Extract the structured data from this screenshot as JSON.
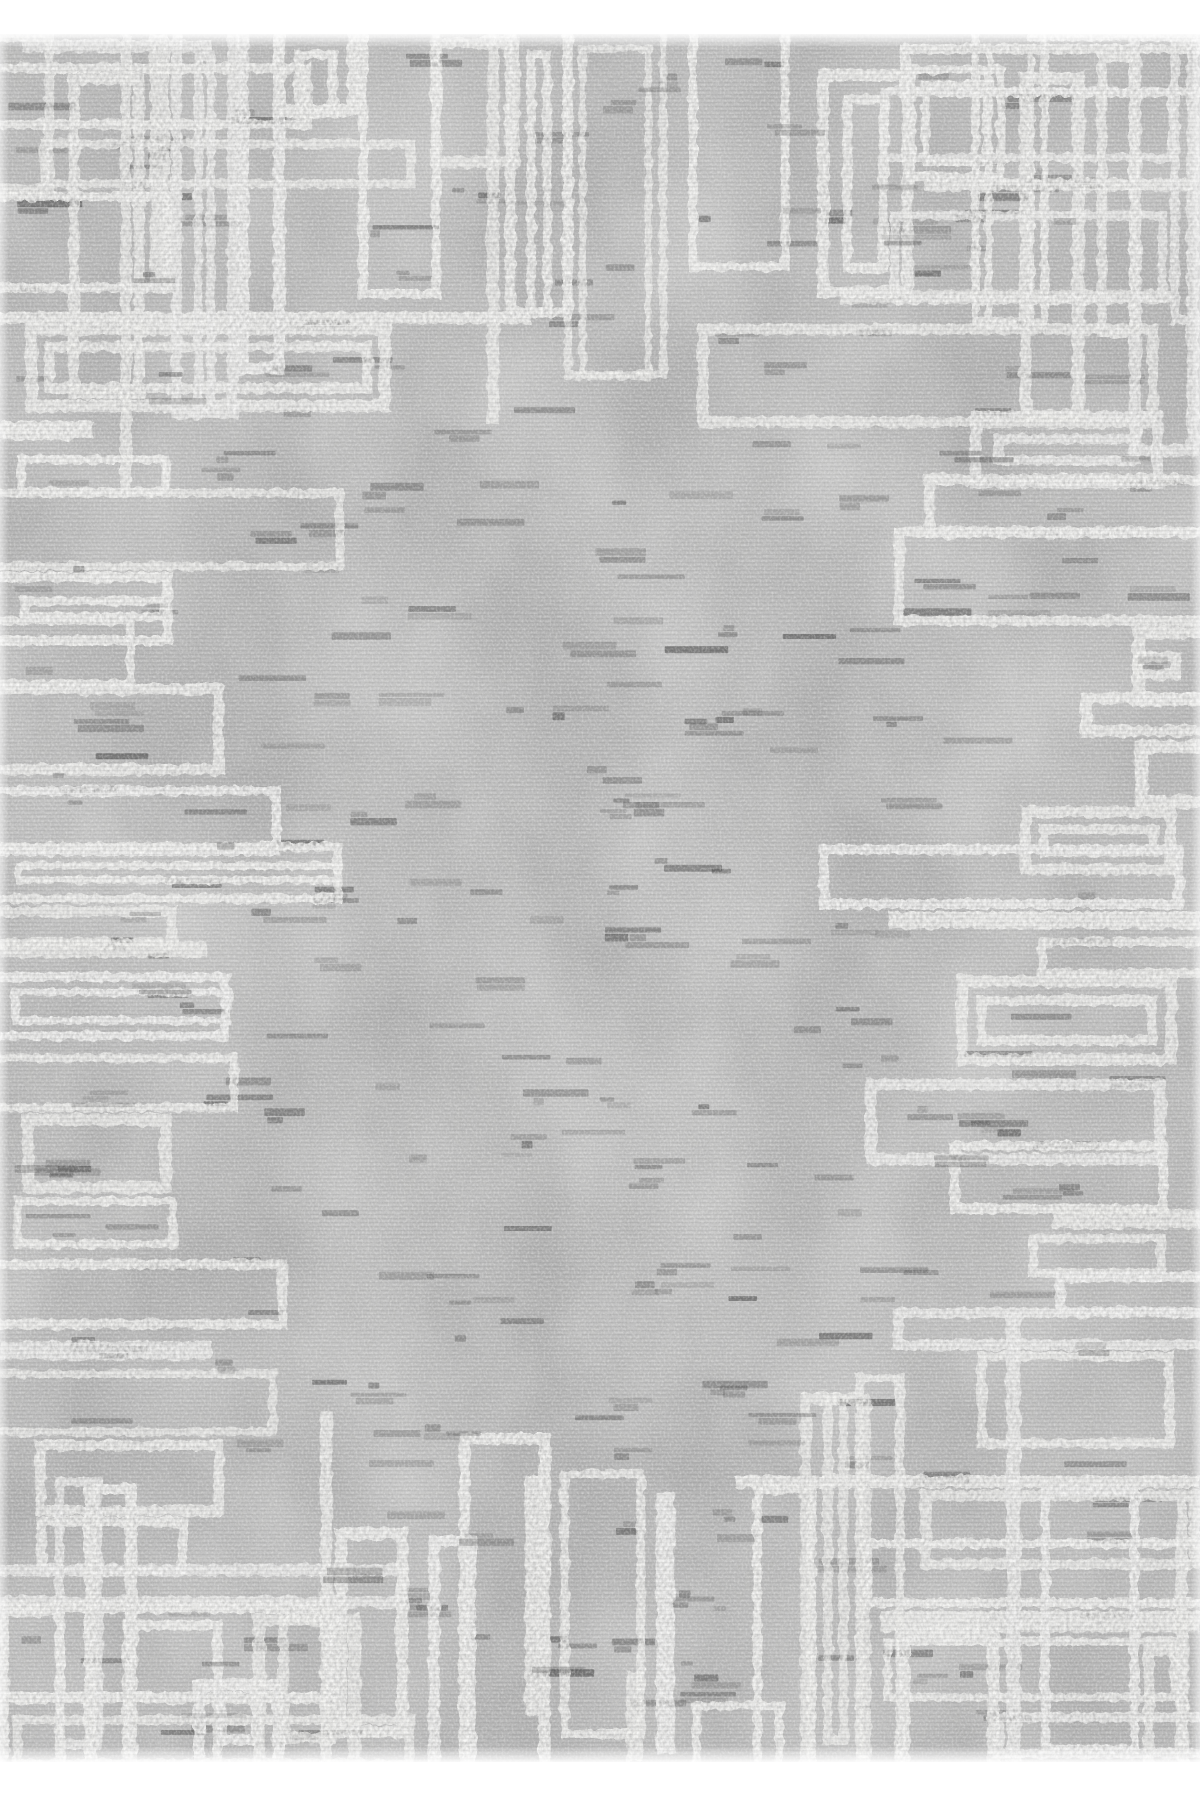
{
  "image": {
    "subject": "distressed gray area rug with white geometric maze border pattern",
    "orientation": "portrait"
  },
  "layout": {
    "canvas_w": 1200,
    "canvas_h": 1800,
    "rug_top": 34,
    "rug_height": 1728,
    "rug_width": 1200
  },
  "seed": 7,
  "palette": {
    "page_background": "#ffffff",
    "base_gray": "#b0b0b0",
    "dark_cloud": "#767676",
    "light_cloud": "#d6d6d6",
    "mid_blotch": "#8c8c8c",
    "pattern_white": "#f6f6f4",
    "fleck_colors": [
      "#3e3e3e",
      "#555555",
      "#6b6b6b"
    ]
  },
  "texture": {
    "grain_light_opacity": 0.5,
    "grain_dark_opacity": 0.32,
    "dark_cloud_opacity": 0.75,
    "light_cloud_opacity": 0.6,
    "mid_blotch_opacity": 0.55,
    "fleck_count_under": 230,
    "fleck_count_over": 80,
    "fleck_min_w": 10,
    "fleck_max_w": 70,
    "fleck_min_h": 4,
    "fleck_max_h": 8,
    "fleck_opacity_min": 0.2,
    "fleck_opacity_max": 0.55,
    "fleck_second_row_chance": 0.45
  },
  "pattern": {
    "stroke_min": 8,
    "stroke_max": 13,
    "breadth_min": 30,
    "breadth_max": 96,
    "depth_min": 70,
    "depth_max": 360,
    "deep_chance": 0.08,
    "deep_extra": 90,
    "corner_frac": 0.18,
    "corner_extra": 135,
    "bar_thickness_min": 10,
    "bar_thickness_max": 22,
    "solid_chance": 0.22,
    "nested_chance": 0.25,
    "open_chance": 0.6,
    "inset_max": 48,
    "opacity_min": 0.8,
    "opacity_max": 0.97,
    "edges": [
      "left",
      "right",
      "top",
      "bottom"
    ]
  }
}
